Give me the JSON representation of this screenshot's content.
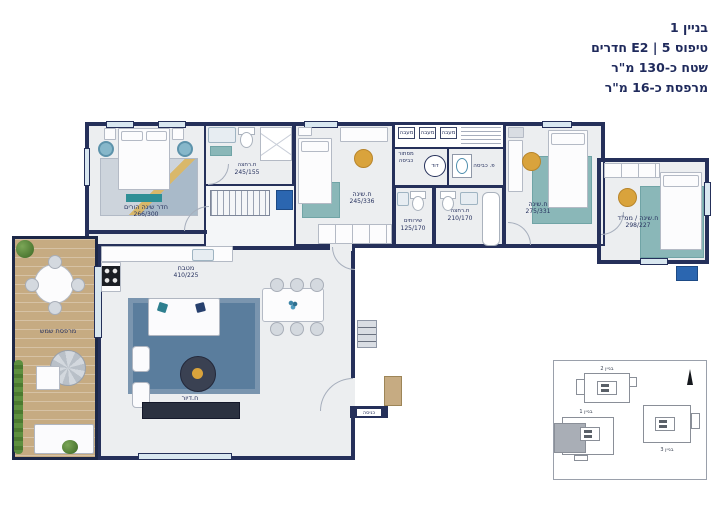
{
  "header": {
    "building": "בניין 1",
    "type_line": "טיפוס E2 | 5 חדרים",
    "area_line": "שטח כ-130 מ\"ר",
    "balcony_line": "מרפסת כ-16 מ\"ר"
  },
  "rooms": {
    "master_bedroom": {
      "label": "חדר שינה הורים",
      "dims": "266/300"
    },
    "master_bath": {
      "label": "ח.רחצה",
      "dims": "245/155"
    },
    "bedroom2": {
      "label": "ח.שינה",
      "dims": "245/336"
    },
    "bedroom3": {
      "label": "ח.שינה",
      "dims": "275/331"
    },
    "mamad": {
      "label": "ח.שינה / ממ\"ד",
      "dims": "298/227"
    },
    "toilet": {
      "label": "שירותים",
      "dims": "125/170"
    },
    "bathroom": {
      "label": "ח.רחצה",
      "dims": "210/170"
    },
    "kitchen": {
      "label": "מטבח",
      "dims": "410/225"
    },
    "living": {
      "label": "ח.דיור"
    },
    "balcony": {
      "label": "מרפסת שמש"
    },
    "laundry": {
      "label": "מסתור כביסה"
    },
    "laundry_corner": {
      "label": "פ. כביסה"
    },
    "boiler": {
      "label": "דוד"
    },
    "condensers": {
      "label": "מעבה"
    },
    "entrance": {
      "label": "כניסה"
    }
  },
  "inset": {
    "building1": "בניין 1",
    "building2": "בניין 2",
    "building3": "בניין 3"
  },
  "colors": {
    "wall": "#25305a",
    "floor": "#eceef0",
    "deck": "#c6ab82",
    "rug_teal": "#8ab7b8",
    "rug_blue": "#5a7d9d",
    "accent_yellow": "#d9a33c",
    "plant_green": "#5d8f3f",
    "text_navy": "#1e2a5e",
    "elevator_blue": "#2b66b0"
  }
}
